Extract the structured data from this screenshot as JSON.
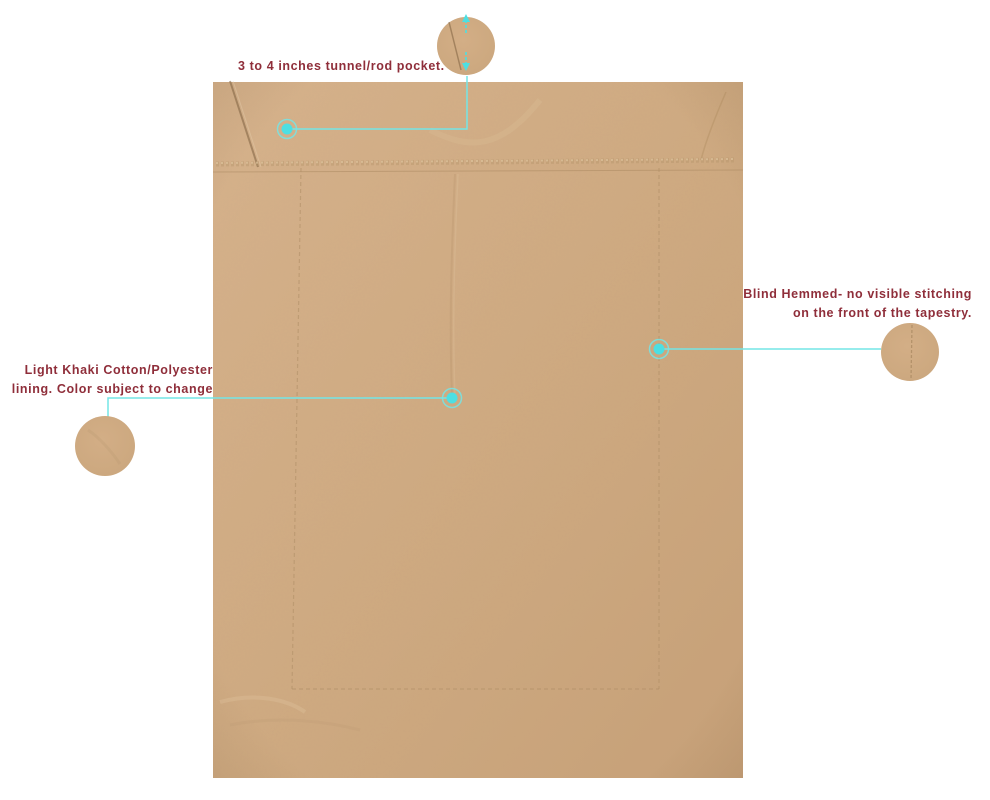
{
  "image_type": "annotated-product-diagram",
  "subject": "tapestry-back-panel",
  "colors": {
    "background": "#ffffff",
    "fabric": "#cfaa81",
    "fabric_light": "#d6b28b",
    "fabric_dark": "#c29d75",
    "accent_cyan": "#5fe2e4",
    "label_red": "#8f2e3a"
  },
  "icons": {
    "callout_dot": "callout-dot-icon",
    "measure_arrows": "measure-arrow-icon",
    "magnifier_circle": "detail-zoom-circle"
  },
  "annotations": {
    "rod_pocket": {
      "text": "3 to 4 inches tunnel/rod pocket."
    },
    "blind_hem": {
      "line1": "Blind Hemmed- no visible stitching",
      "line2": "on the front of the tapestry."
    },
    "lining": {
      "line1": "Light Khaki Cotton/Polyester",
      "line2": "lining. Color subject to change"
    }
  }
}
